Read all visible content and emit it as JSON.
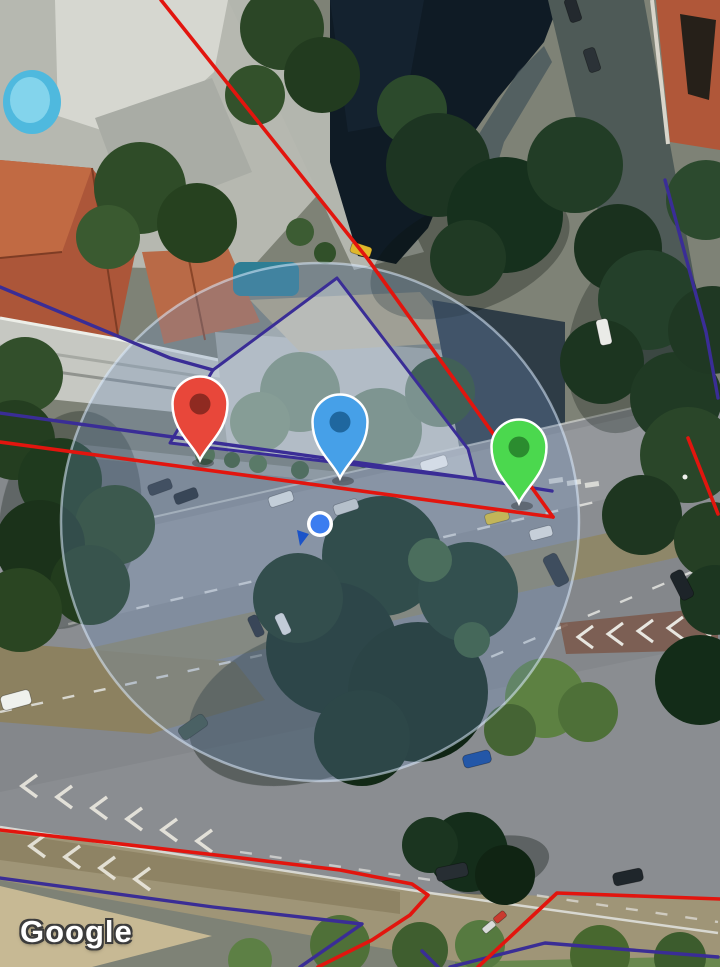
{
  "map": {
    "watermark": "Google",
    "view": "satellite",
    "overlay_colors": {
      "boundary_red": "#e2150e",
      "boundary_blue": "#3a2d96",
      "parcel_fill": "rgba(232,238,250,0.35)",
      "accuracy_fill": "rgba(108,142,188,0.30)",
      "accuracy_stroke": "rgba(222,236,255,0.55)"
    },
    "accuracy_circle": {
      "cx": 320,
      "cy": 522,
      "r": 259
    },
    "user_location": {
      "x": 320,
      "y": 524,
      "dot_color": "#3b7df0",
      "ring_color": "#ffffff",
      "heading_color": "#1b53c8",
      "heading_points": "297,530 309,534 300,546"
    },
    "markers": [
      {
        "id": "marker-red",
        "body": "#e8473a",
        "inner": "#8f2a21",
        "outline": "#ffffff",
        "tip_x": 200,
        "tip_y": 460
      },
      {
        "id": "marker-blue",
        "body": "#46a0e8",
        "inner": "#1f679f",
        "outline": "#ffffff",
        "tip_x": 340,
        "tip_y": 478
      },
      {
        "id": "marker-green",
        "body": "#4bd84e",
        "inner": "#2b8c2f",
        "outline": "#ffffff",
        "tip_x": 519,
        "tip_y": 503
      }
    ],
    "parcel_polygon": {
      "points": [
        [
          337,
          278
        ],
        [
          213,
          370
        ],
        [
          170,
          443
        ],
        [
          476,
          479
        ],
        [
          468,
          449
        ]
      ]
    },
    "boundary_lines": {
      "red": [
        {
          "points": [
            [
              161,
              0
            ],
            [
              367,
              258
            ],
            [
              553,
              517
            ]
          ]
        },
        {
          "points": [
            [
              0,
              442
            ],
            [
              553,
              517
            ]
          ]
        },
        {
          "points": [
            [
              688,
              438
            ],
            [
              718,
              514
            ]
          ]
        },
        {
          "points": [
            [
              0,
              830
            ],
            [
              233,
              857
            ],
            [
              340,
              870
            ],
            [
              412,
              884
            ],
            [
              428,
              895
            ],
            [
              410,
              915
            ],
            [
              372,
              940
            ],
            [
              318,
              967
            ]
          ]
        },
        {
          "points": [
            [
              720,
              899
            ],
            [
              557,
              893
            ],
            [
              478,
              967
            ]
          ]
        }
      ],
      "blue": [
        {
          "points": [
            [
              0,
              287
            ],
            [
              170,
              358
            ],
            [
              213,
              370
            ]
          ]
        },
        {
          "points": [
            [
              0,
              413
            ],
            [
              476,
              479
            ],
            [
              552,
              491
            ]
          ]
        },
        {
          "points": [
            [
              665,
              180
            ],
            [
              706,
              332
            ],
            [
              718,
              398
            ]
          ]
        },
        {
          "points": [
            [
              0,
              878
            ],
            [
              213,
              907
            ],
            [
              362,
              924
            ],
            [
              300,
              967
            ]
          ]
        },
        {
          "points": [
            [
              450,
              967
            ],
            [
              545,
              943
            ],
            [
              718,
              957
            ]
          ]
        },
        {
          "points": [
            [
              422,
              951
            ],
            [
              438,
              967
            ]
          ]
        }
      ]
    }
  }
}
